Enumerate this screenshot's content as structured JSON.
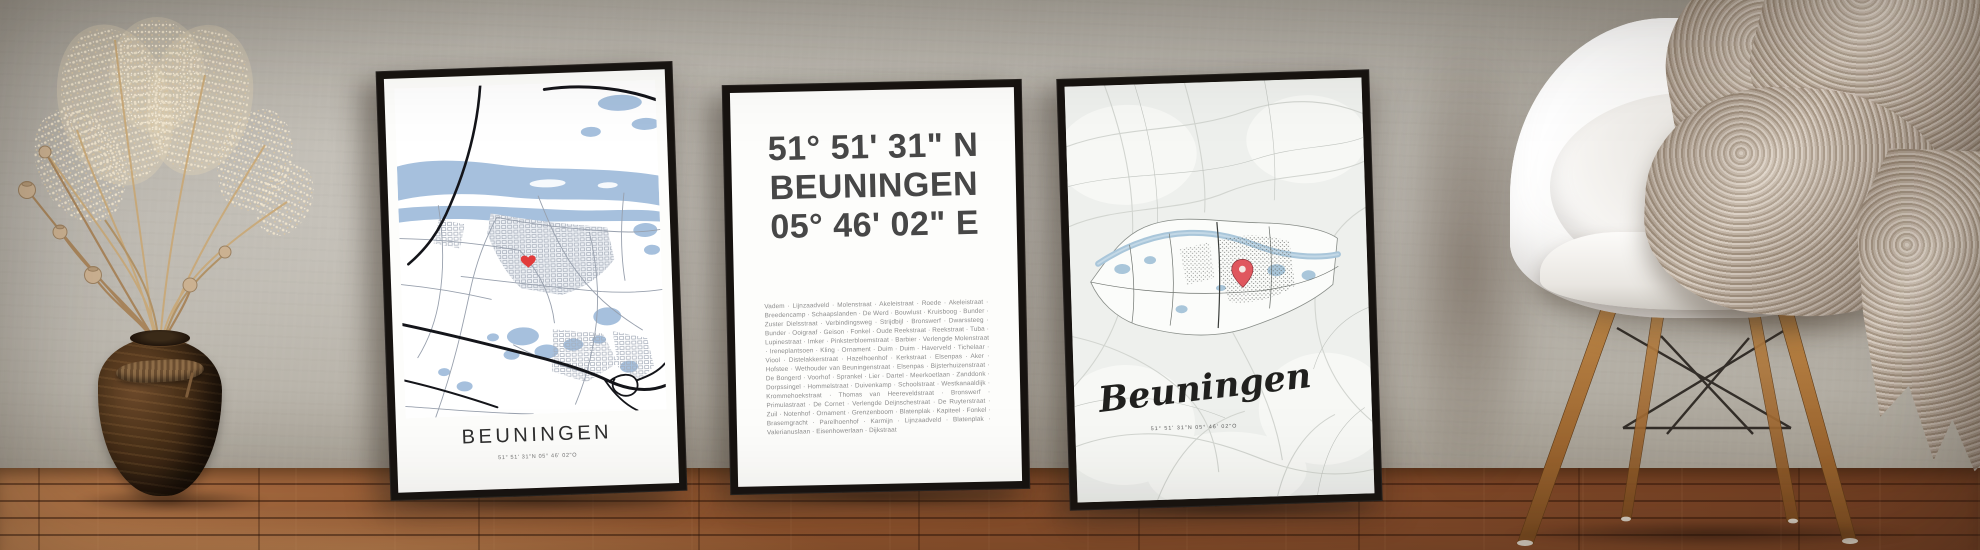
{
  "posters": {
    "left": {
      "title": "BEUNINGEN",
      "coordinates": "51° 51' 31\"N 05° 46' 02\"O"
    },
    "middle": {
      "latitude": "51° 51' 31\" N",
      "city": "BEUNINGEN",
      "longitude": "05° 46' 02\" E",
      "separator": "  ·  ",
      "streets": [
        "Vadem",
        "Lijnzaadveld",
        "Molenstraat",
        "Akeleistraat",
        "Roede",
        "Akeleistraat",
        "Breedencamp",
        "Schaapslanden",
        "De Werd",
        "Bouwlust",
        "Kruisboog",
        "Bunder",
        "Zuster Dielsstraat",
        "Verbindingsweg",
        "Strijdbijl",
        "Bronswerf",
        "Dwarssteeg",
        "Bunder",
        "Ooigraaf",
        "Geison",
        "Fonkel",
        "Oude Reekstraat",
        "Reekstraat",
        "Tuba",
        "Lupinestraat",
        "Imker",
        "Pinksterbloemstraat",
        "Barbier",
        "Verlengde Molenstraat",
        "Ireneplantsoen",
        "Kling",
        "Ornament",
        "Duim",
        "Duim",
        "Haverveld",
        "Tichelaar",
        "Viool",
        "Distelakkerstraat",
        "Hazelhoenhof",
        "Kerkstraat",
        "Elsenpas",
        "Aker",
        "Hofstee",
        "Wethouder van Beuningenstraat",
        "Elsenpas",
        "Bijsterhuizenstraat",
        "De Bongerd",
        "Voorhof",
        "Sprankel",
        "Lier",
        "Dartel",
        "Meerkoetlaan",
        "Zanddonk",
        "Dorpssingel",
        "Hommelstraat",
        "Duivenkamp",
        "Schoolstraat",
        "Westkanaaldijk",
        "Krommehoekstraat",
        "Thomas van Heereveldstraat",
        "Bronswerf",
        "Primulastraat",
        "De Cornet",
        "Verlengde Deijnschestraat",
        "De Ruyterstraat",
        "Zuil",
        "Notenhof",
        "Ornament",
        "Grenzenboom",
        "Blatenplak",
        "Kapiteel",
        "Fonkel",
        "Brasemgracht",
        "Parelhoenhof",
        "Karmijn",
        "Lijnzaadveld",
        "Blatenplak",
        "Valerianuslaan",
        "Eisenhowerlaan",
        "Dijkstraat"
      ]
    },
    "right": {
      "title": "Beuningen",
      "coordinates": "51° 51' 31\"N 05° 46' 02\"O"
    }
  },
  "colors": {
    "wall": "#b7b3ab",
    "floor_wood": "#8a4e2b",
    "frame": "#171310",
    "poster_paper": "#fdfdfb",
    "map_water": "#a6c0dd",
    "map_road_dark": "#14151a",
    "map_road_gray": "#98a0ad",
    "muted_map_bg": "#eef0ed",
    "muted_map_road": "#d2d5d0",
    "marker_red": "#e23b3b",
    "pin_red": "#e0575e",
    "heading_text": "#474747",
    "street_text": "#8d8d8d",
    "blanket_taupe": "#bfb1a2",
    "chair_shell": "#f2f0ed",
    "vase_wood": "#4a3119"
  }
}
